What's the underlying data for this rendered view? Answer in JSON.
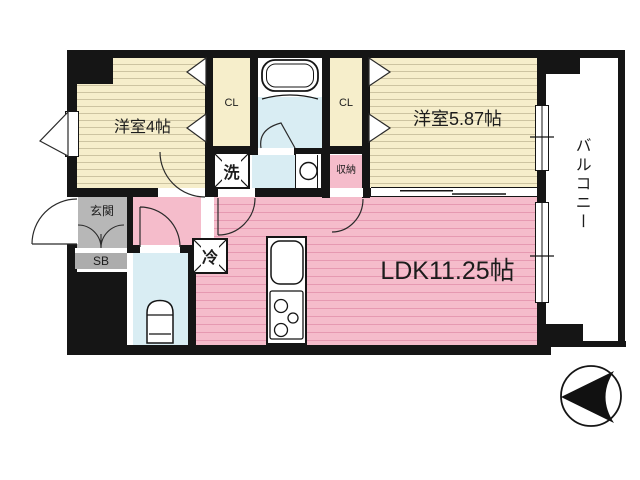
{
  "rooms": {
    "bedroom1": "洋室4帖",
    "bedroom2": "洋室5.87帖",
    "ldk": "LDK11.25帖",
    "balcony": "バルコニー",
    "closet1": "CL",
    "closet2": "CL",
    "storage": "収納",
    "entrance": "玄関",
    "shoe_box": "SB",
    "laundry": "洗",
    "refrigerator": "冷"
  },
  "colors": {
    "wall": "#151515",
    "room_yellow": "#f6eecb",
    "ldk_pink": "#f5bccb",
    "water_blue": "#d9edf3",
    "entrance_gray": "#b7b7b7"
  }
}
